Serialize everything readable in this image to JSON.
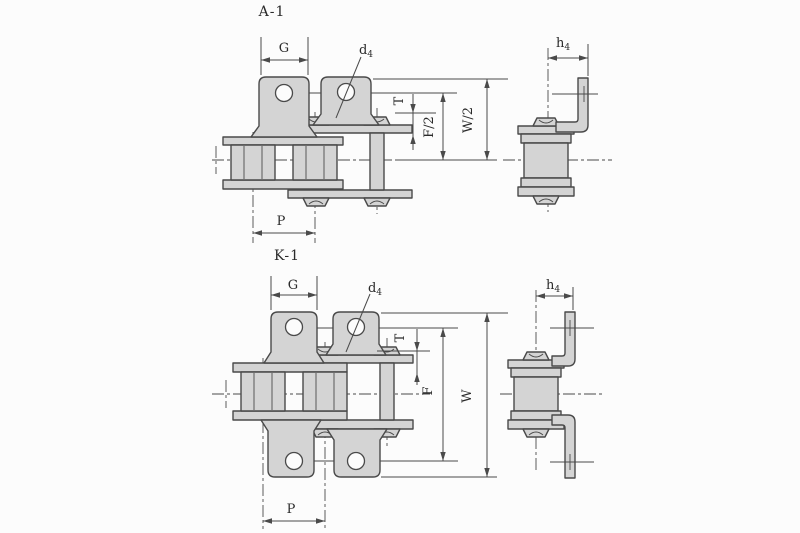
{
  "drawing": {
    "type": "roller-chain-attachment-technical-drawing",
    "colors": {
      "background": "#fcfcfc",
      "part_fill": "#d4d4d4",
      "outline": "#4a4a4a",
      "text": "#2a2a2a"
    },
    "figure_a1": {
      "title": "A-1",
      "labels": {
        "plate_width": "G",
        "hole_dia_base": "d",
        "hole_dia_sub": "4",
        "lug_height_base": "h",
        "lug_height_sub": "4",
        "thickness": "T",
        "flange_height": "F/2",
        "overall_height": "W/2",
        "pitch": "P"
      }
    },
    "figure_k1": {
      "title": "K-1",
      "labels": {
        "plate_width": "G",
        "hole_dia_base": "d",
        "hole_dia_sub": "4",
        "lug_height_base": "h",
        "lug_height_sub": "4",
        "thickness": "T",
        "flange_height": "F",
        "overall_height": "W",
        "pitch": "P"
      }
    }
  }
}
